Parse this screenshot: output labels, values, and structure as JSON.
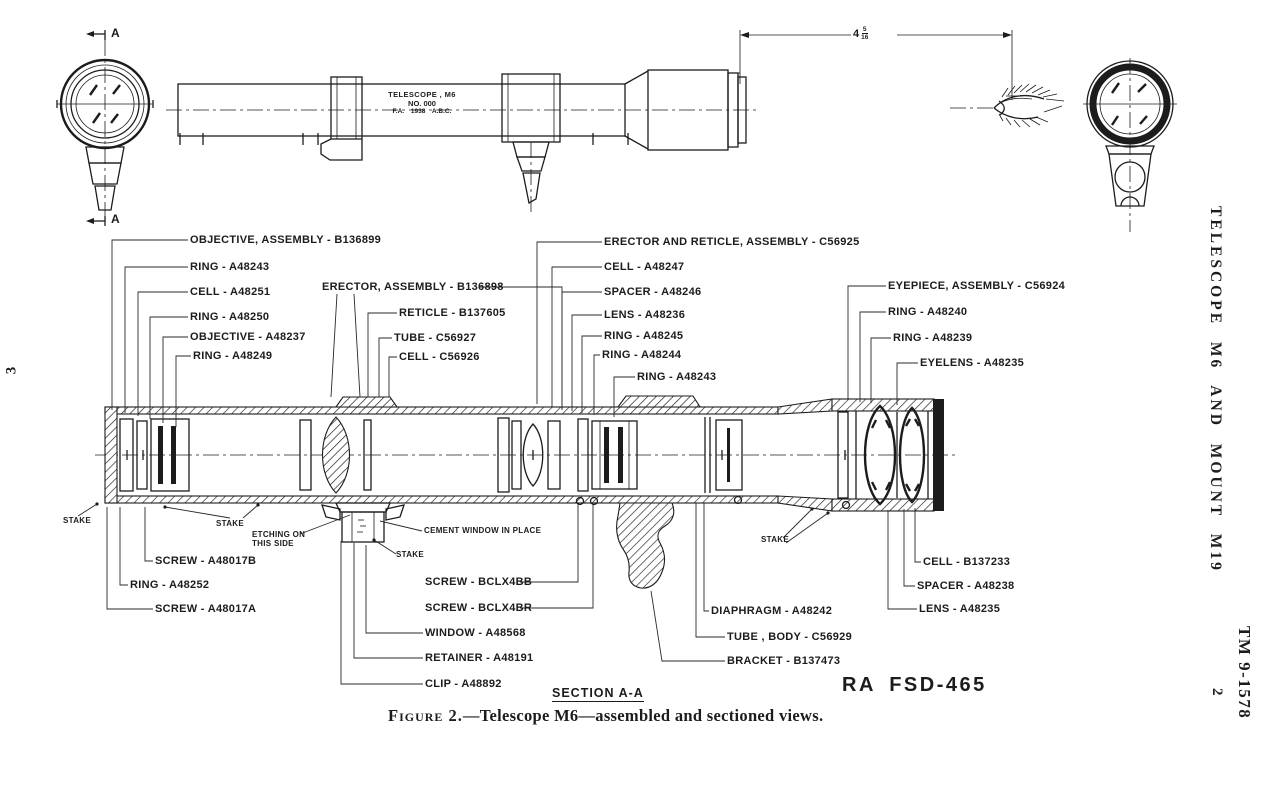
{
  "page": {
    "left_page_number": "3",
    "side_header": "TELESCOPE M6 AND MOUNT M19",
    "manual_number": "TM 9-1578",
    "paragraph_number": "2",
    "section_label": "SECTION A-A",
    "drawing_number": "RA FSD-465",
    "caption_label": "Figure 2.",
    "caption_text": "—Telescope M6—assembled and sectioned views."
  },
  "assembled_view": {
    "marking_line1": "TELESCOPE , M6",
    "marking_line2": "NO. 000",
    "marking_line3": "F.A. 1938 A.B.C.",
    "dimension_whole": "4",
    "dimension_numerator": "5",
    "dimension_denominator": "16",
    "section_marker": "A"
  },
  "parts": {
    "objective_assembly": "OBJECTIVE, ASSEMBLY - B136899",
    "ring_a48243_left": "RING - A48243",
    "cell_a48251": "CELL - A48251",
    "ring_a48250": "RING - A48250",
    "objective_a48237": "OBJECTIVE - A48237",
    "ring_a48249": "RING - A48249",
    "erector_assembly": "ERECTOR, ASSEMBLY - B136898",
    "reticle_b137605": "RETICLE - B137605",
    "tube_c56927": "TUBE - C56927",
    "cell_c56926": "CELL - C56926",
    "erector_reticle_assembly": "ERECTOR AND RETICLE, ASSEMBLY - C56925",
    "cell_a48247": "CELL - A48247",
    "spacer_a48246": "SPACER - A48246",
    "lens_a48236": "LENS - A48236",
    "ring_a48245": "RING - A48245",
    "ring_a48244": "RING - A48244",
    "ring_a48243_right": "RING - A48243",
    "eyepiece_assembly": "EYEPIECE, ASSEMBLY - C56924",
    "ring_a48240": "RING - A48240",
    "ring_a48239": "RING - A48239",
    "eyelens_a48235": "EYELENS - A48235",
    "screw_a48017b": "SCREW - A48017B",
    "ring_a48252": "RING - A48252",
    "screw_a48017a": "SCREW - A48017A",
    "screw_bclx4bb": "SCREW - BCLX4BB",
    "screw_bclx4br": "SCREW - BCLX4BR",
    "window_a48568": "WINDOW - A48568",
    "retainer_a48191": "RETAINER - A48191",
    "clip_a48892": "CLIP - A48892",
    "diaphragm_a48242": "DIAPHRAGM - A48242",
    "tube_body_c56929": "TUBE , BODY - C56929",
    "bracket_b137473": "BRACKET - B137473",
    "cell_b137233": "CELL - B137233",
    "spacer_a48238": "SPACER - A48238",
    "lens_a48235": "LENS - A48235"
  },
  "annotations": {
    "stake": "STAKE",
    "etching_line1": "ETCHING ON",
    "etching_line2": "THIS SIDE",
    "cement_note": "CEMENT WINDOW IN PLACE"
  },
  "colors": {
    "ink": "#1c1c1c",
    "paper": "#ffffff"
  }
}
